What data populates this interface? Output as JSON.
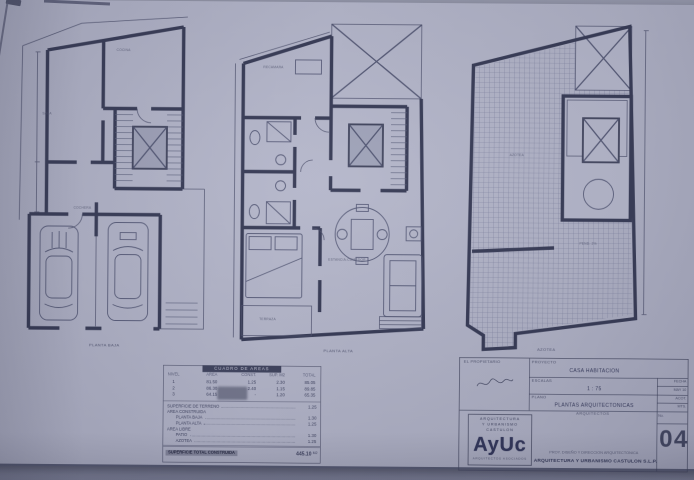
{
  "photo": {
    "paper_color": "#b1b3c7",
    "ink_color": "#3c4059",
    "backdrop_color": "#8f92a5"
  },
  "plans": [
    {
      "label": "PLANTA BAJA",
      "annotations": [
        "SALA",
        "COCINA",
        "COCHERA"
      ]
    },
    {
      "label": "PLANTA ALTA",
      "annotations": [
        "RECAMARA",
        "ESTANCIA-COMEDOR",
        "TERRAZA"
      ]
    },
    {
      "label": "AZOTEA",
      "annotations": [
        "AZOTEA",
        "PEND. 2%"
      ]
    }
  ],
  "areas_table": {
    "title": "CUADRO DE AREAS",
    "headers": [
      "NIVEL",
      "AREA",
      "CONST.",
      "SUP. M2",
      "TOTAL"
    ],
    "level_rows": [
      [
        "1",
        "81.50",
        "1.25",
        "2.30",
        "85.05"
      ],
      [
        "2",
        "86.30",
        "2.40",
        "1.15",
        "89.85"
      ],
      [
        "3",
        "64.15",
        "-",
        "1.20",
        "65.35"
      ]
    ],
    "item_rows": [
      [
        "SUPERFICIE DE TERRENO",
        "1.25"
      ],
      [
        "AREA CONSTRUIDA",
        ""
      ],
      [
        "PLANTA BAJA",
        "1.30"
      ],
      [
        "PLANTA ALTA",
        "1.25"
      ],
      [
        "AREA LIBRE",
        ""
      ],
      [
        "PATIO",
        "1.30"
      ],
      [
        "AZOTEA",
        "1.25"
      ]
    ],
    "total_label": "SUPERFICIE TOTAL CONSTRUIDA",
    "total_value": "445.10",
    "total_unit": "M2"
  },
  "title_block": {
    "owner_label": "EL PROPIETARIO",
    "project_label": "PROYECTO",
    "project_value": "CASA HABITACION",
    "scale_label": "ESCALAS",
    "scale_value": "1 : 75",
    "plan_label": "PLANO",
    "plan_value": "PLANTAS ARQUITECTONICAS",
    "side_cells": [
      "FECHA",
      "MAY 10",
      "ACOT.",
      "MTS."
    ],
    "arch_header": "ARQUITECTOS",
    "credit_line": "PROY. DISEÑO Y DIRECCION ARQUITECTONICA",
    "firm_line": "ARQUITECTURA Y URBANISMO CASTULON S.L.P.",
    "sheet_label": "No.",
    "sheet_number": "04",
    "logo_lines": [
      "ARQUITECTURA",
      "Y URBANISMO",
      "CASTULON"
    ],
    "logo_text": "AyUc",
    "logo_footer": "ARQUITECTOS ASOCIADOS"
  }
}
